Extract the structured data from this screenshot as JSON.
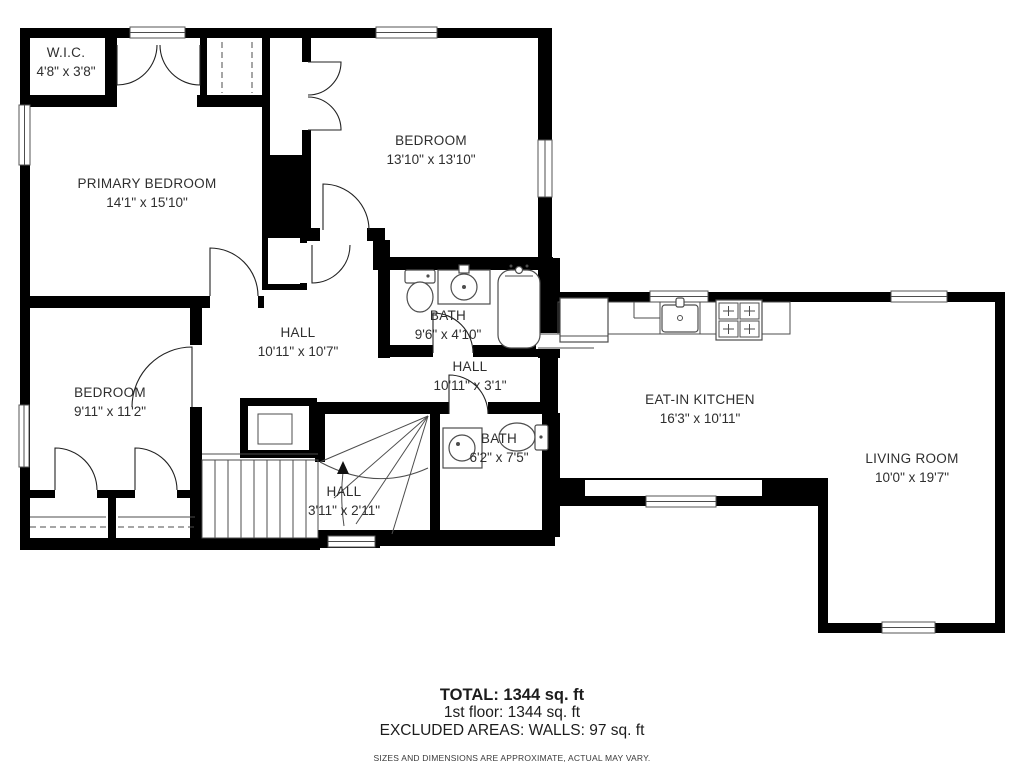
{
  "rooms": {
    "wic": {
      "name": "W.I.C.",
      "dims": "4'8\" x 3'8\""
    },
    "primary": {
      "name": "PRIMARY BEDROOM",
      "dims": "14'1\" x 15'10\""
    },
    "bedroom2": {
      "name": "BEDROOM",
      "dims": "13'10\" x 13'10\""
    },
    "bath1": {
      "name": "BATH",
      "dims": "9'6\" x 4'10\""
    },
    "hall1": {
      "name": "HALL",
      "dims": "10'11\" x 10'7\""
    },
    "hall2": {
      "name": "HALL",
      "dims": "10'11\" x 3'1\""
    },
    "bedroom3": {
      "name": "BEDROOM",
      "dims": "9'11\" x 11'2\""
    },
    "bath2": {
      "name": "BATH",
      "dims": "6'2\" x 7'5\""
    },
    "hall3": {
      "name": "HALL",
      "dims": "3'11\" x 2'11\""
    },
    "kitchen": {
      "name": "EAT-IN KITCHEN",
      "dims": "16'3\" x 10'11\""
    },
    "living": {
      "name": "LIVING ROOM",
      "dims": "10'0\" x 19'7\""
    }
  },
  "footer": {
    "total": "TOTAL: 1344 sq. ft",
    "floor1": "1st floor: 1344 sq. ft",
    "excluded": "EXCLUDED AREAS: WALLS: 97 sq. ft",
    "disclaimer": "SIZES AND DIMENSIONS ARE APPROXIMATE, ACTUAL MAY VARY."
  },
  "colors": {
    "wall": "#000000",
    "background": "#ffffff",
    "line": "#4d4d4d",
    "text": "#2e2e2e"
  }
}
